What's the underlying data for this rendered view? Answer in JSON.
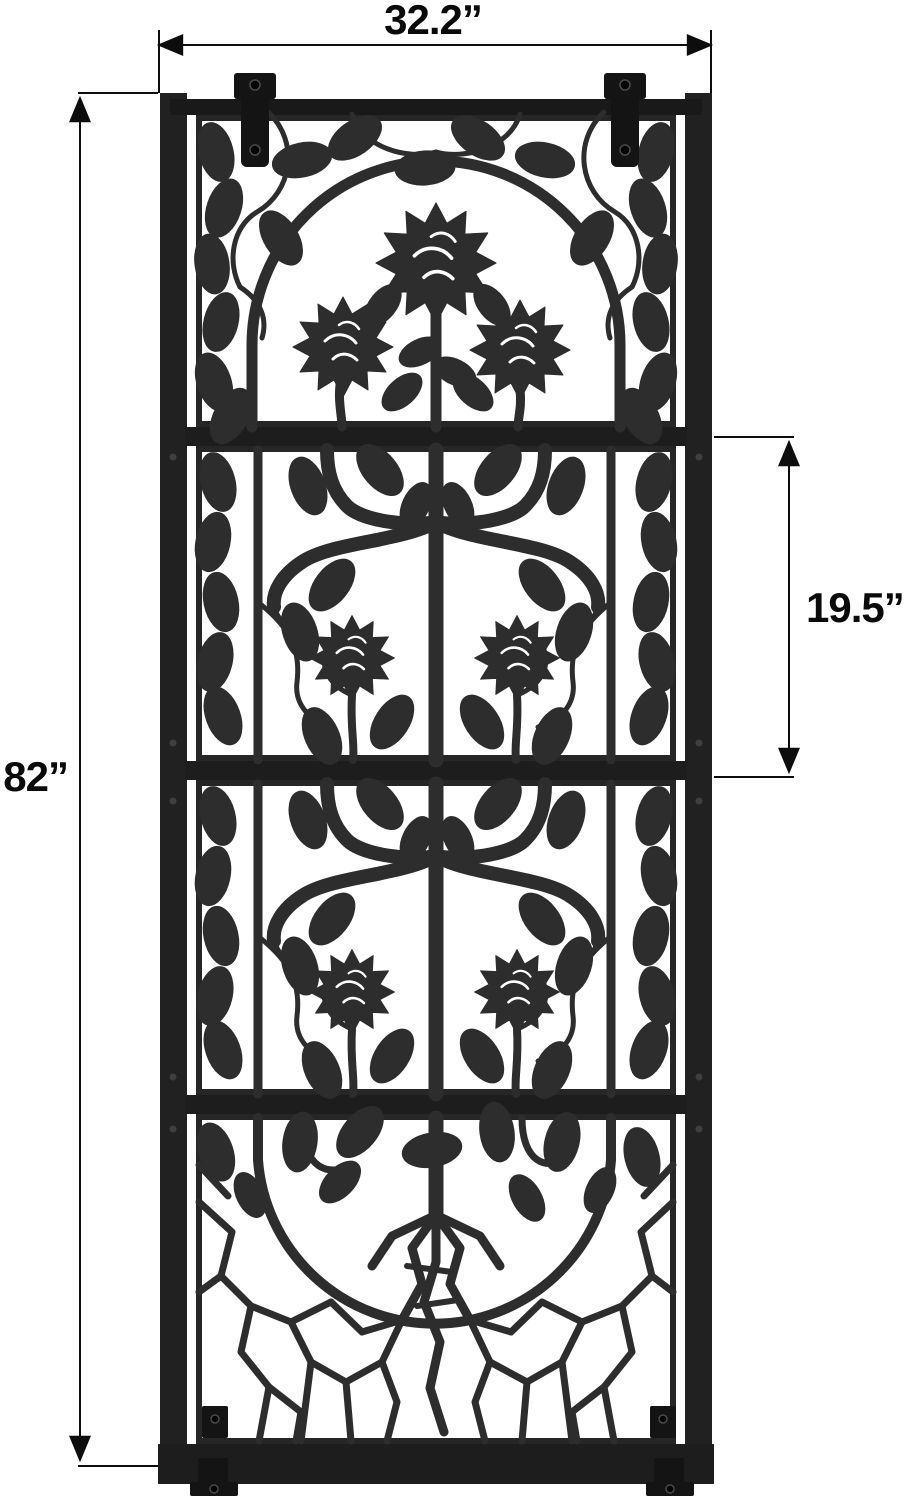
{
  "dimension_labels": {
    "width": "32.2”",
    "height": "82”",
    "section_height": "19.5”"
  },
  "colors": {
    "background": "#ffffff",
    "frame": "#212121",
    "cutout_art": "#2d2d2d",
    "bracket": "#141414",
    "dimension_line": "#0d0d0d"
  }
}
